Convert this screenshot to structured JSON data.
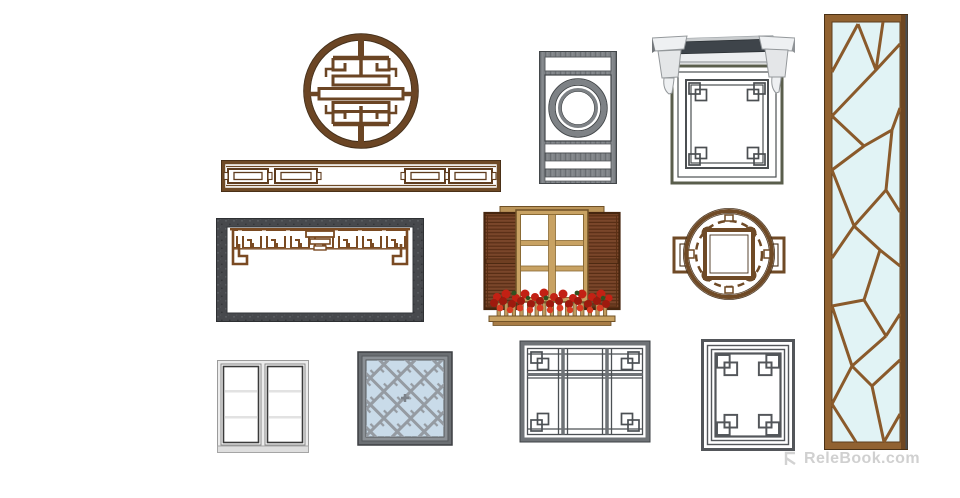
{
  "page": {
    "background_color": "#ffffff"
  },
  "watermark": {
    "icon": "relebook-logo-icon",
    "text": "ReleBook.com",
    "color": "#cecece"
  },
  "palette": {
    "wood_brown": "#6f4a26",
    "wood_brown_dark": "#46301a",
    "wood_tan": "#c8a263",
    "shutter_brown": "#7a462a",
    "flower_red": "#c32114",
    "stone_gray": "#47494d",
    "steel_gray": "#6f7377",
    "steel_gray_dark": "#4c5054",
    "olive_frame": "#5a5e4c",
    "cornice_white": "#eef0f2",
    "roof_slab_gray": "#3e444a",
    "glass_cyan": "#e1f3f5",
    "glass_blue_gray": "#c9dbe9",
    "white_pvc": "#ececec"
  },
  "items": [
    {
      "name": "round-shou-window",
      "label": "circular carved wood lattice medallion"
    },
    {
      "name": "lattice-transom-band",
      "label": "long horizontal wood lattice transom"
    },
    {
      "name": "stone-frame-with-valance",
      "label": "stone opening with carved wood valance"
    },
    {
      "name": "vertical-circle-window",
      "label": "tall gray window with double circle"
    },
    {
      "name": "cornice-window",
      "label": "lattice window with stone cornice and corbels"
    },
    {
      "name": "round-ear-window",
      "label": "round lattice window with side ears"
    },
    {
      "name": "ice-crack-screen",
      "label": "tall ice-crack lattice screen with glass"
    },
    {
      "name": "shuttered-flower-window",
      "label": "window with louvered shutters and flower box"
    },
    {
      "name": "white-casement-window",
      "label": "white double casement window"
    },
    {
      "name": "square-fret-window",
      "label": "square diagonal fret lattice window"
    },
    {
      "name": "gray-mullion-window",
      "label": "gray window with mullions and corner knots"
    },
    {
      "name": "corner-knot-frame",
      "label": "rectangular frame with corner knot lattice"
    }
  ]
}
